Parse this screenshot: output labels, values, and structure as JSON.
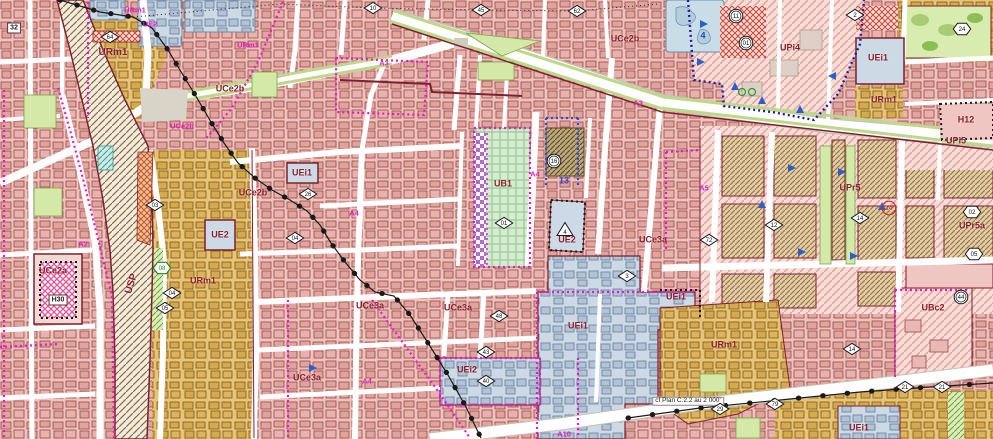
{
  "map": {
    "kind": "urban-zoning-plan",
    "plan_reference_note": "cf Plan C.2.2 au 2 000'",
    "colors": {
      "pink_zone": "#eec3be",
      "pink_building": "#dfa49e",
      "building_outline": "#9a4a46",
      "tan_zone": "#e8c478",
      "tan_building": "#d5a94e",
      "blue_zone": "#cdd9e5",
      "blue_building": "#b2c3d5",
      "green_grid_zone": "#d6ecd0",
      "park_green": "#d4e8a8",
      "rail_band": "#f3ecda",
      "rail_hatch": "#8a6b4c",
      "magenta_border": "#ea18c8",
      "navy_border": "#20209a",
      "blue_border": "#2a50d8",
      "black_border": "#1c1c1c",
      "dark_red_border": "#7c2130",
      "zone_label": "#8c1f2e",
      "street_label": "#e020c0",
      "blue_label": "#2848c8"
    },
    "labels": [
      {
        "text": "URm1",
        "x": 113,
        "y": 53,
        "style": "zone",
        "size": "big"
      },
      {
        "text": "UCe2b",
        "x": 230,
        "y": 89,
        "style": "zone"
      },
      {
        "text": "UCe2b",
        "x": 625,
        "y": 39,
        "style": "zone"
      },
      {
        "text": "UCe2b",
        "x": 253,
        "y": 193,
        "style": "zone"
      },
      {
        "text": "UCe2a",
        "x": 53,
        "y": 271,
        "style": "zone"
      },
      {
        "text": "URm1",
        "x": 203,
        "y": 281,
        "style": "zone"
      },
      {
        "text": "UEi1",
        "x": 302,
        "y": 173,
        "style": "zone"
      },
      {
        "text": "UE2",
        "x": 220,
        "y": 235,
        "style": "zone"
      },
      {
        "text": "UB1",
        "x": 503,
        "y": 184,
        "style": "zone"
      },
      {
        "text": "UE2",
        "x": 567,
        "y": 240,
        "style": "zone"
      },
      {
        "text": "UCe3a",
        "x": 653,
        "y": 240,
        "style": "zone"
      },
      {
        "text": "UCe3a",
        "x": 370,
        "y": 306,
        "style": "zone"
      },
      {
        "text": "UCe3a",
        "x": 458,
        "y": 308,
        "style": "zone"
      },
      {
        "text": "UCe3a",
        "x": 307,
        "y": 378,
        "style": "zone"
      },
      {
        "text": "UEi2",
        "x": 467,
        "y": 370,
        "style": "zone"
      },
      {
        "text": "UEi1",
        "x": 578,
        "y": 326,
        "style": "zone"
      },
      {
        "text": "UEi1",
        "x": 676,
        "y": 297,
        "style": "zone"
      },
      {
        "text": "URm1",
        "x": 724,
        "y": 345,
        "style": "zone"
      },
      {
        "text": "UEi1",
        "x": 859,
        "y": 428,
        "style": "zone"
      },
      {
        "text": "UPi4",
        "x": 790,
        "y": 48,
        "style": "zone"
      },
      {
        "text": "UPr5",
        "x": 850,
        "y": 188,
        "style": "zone"
      },
      {
        "text": "UPr5a",
        "x": 972,
        "y": 226,
        "style": "zone"
      },
      {
        "text": "UPi5",
        "x": 956,
        "y": 141,
        "style": "zone"
      },
      {
        "text": "URm1",
        "x": 884,
        "y": 100,
        "style": "zone"
      },
      {
        "text": "UEi1",
        "x": 878,
        "y": 58,
        "style": "zone"
      },
      {
        "text": "H12",
        "x": 966,
        "y": 120,
        "style": "zone"
      },
      {
        "text": "UBc2",
        "x": 933,
        "y": 308,
        "style": "zone"
      },
      {
        "text": "USP",
        "x": 132,
        "y": 284,
        "style": "usp"
      },
      {
        "text": "URm1",
        "x": 135,
        "y": 10,
        "style": "street"
      },
      {
        "text": "UE2",
        "x": 150,
        "y": 24,
        "style": "street"
      },
      {
        "text": "URm1",
        "x": 248,
        "y": 45,
        "style": "street"
      },
      {
        "text": "UCe2b",
        "x": 182,
        "y": 126,
        "style": "street"
      },
      {
        "text": "A2",
        "x": 83,
        "y": 244,
        "style": "street"
      },
      {
        "text": "A3",
        "x": 384,
        "y": 63,
        "style": "street"
      },
      {
        "text": "A3",
        "x": 638,
        "y": 103,
        "style": "street"
      },
      {
        "text": "A4",
        "x": 354,
        "y": 213,
        "style": "street"
      },
      {
        "text": "A4",
        "x": 535,
        "y": 174,
        "style": "street"
      },
      {
        "text": "A4",
        "x": 367,
        "y": 381,
        "style": "street"
      },
      {
        "text": "A5",
        "x": 704,
        "y": 188,
        "style": "street"
      },
      {
        "text": "A10",
        "x": 564,
        "y": 434,
        "style": "street"
      },
      {
        "text": "13",
        "x": 564,
        "y": 181,
        "style": "blue"
      },
      {
        "text": "4",
        "x": 703,
        "y": 36,
        "style": "blue"
      },
      {
        "text": "32",
        "x": 14,
        "y": 28,
        "style": "box"
      },
      {
        "text": "H30",
        "x": 58,
        "y": 300,
        "style": "box"
      },
      {
        "text": "cf Plan C.2.2 au 2 000'",
        "x": 688,
        "y": 401,
        "style": "note"
      }
    ],
    "markers": [
      {
        "shape": "diamond",
        "value": "64",
        "x": 110,
        "y": 37
      },
      {
        "shape": "diamond",
        "value": "03",
        "x": 155,
        "y": 205
      },
      {
        "shape": "diamond",
        "value": "04",
        "x": 172,
        "y": 293
      },
      {
        "shape": "diamond",
        "value": "05",
        "x": 165,
        "y": 308
      },
      {
        "shape": "diamond",
        "value": "26",
        "x": 308,
        "y": 194
      },
      {
        "shape": "diamond",
        "value": "04",
        "x": 295,
        "y": 238
      },
      {
        "shape": "diamond",
        "value": "01",
        "x": 504,
        "y": 223
      },
      {
        "shape": "diamond",
        "value": "48",
        "x": 499,
        "y": 316
      },
      {
        "shape": "diamond",
        "value": "43",
        "x": 486,
        "y": 352
      },
      {
        "shape": "diamond",
        "value": "40",
        "x": 486,
        "y": 381
      },
      {
        "shape": "diamond",
        "value": "14",
        "x": 860,
        "y": 218
      },
      {
        "shape": "diamond",
        "value": "12",
        "x": 774,
        "y": 225
      },
      {
        "shape": "diamond",
        "value": "72",
        "x": 709,
        "y": 240
      },
      {
        "shape": "diamond",
        "value": "29",
        "x": 720,
        "y": 409
      },
      {
        "shape": "diamond",
        "value": "79",
        "x": 775,
        "y": 404
      },
      {
        "shape": "diamond",
        "value": "14",
        "x": 852,
        "y": 349
      },
      {
        "shape": "diamond",
        "value": "21",
        "x": 905,
        "y": 387
      },
      {
        "shape": "diamond",
        "value": "21",
        "x": 942,
        "y": 387
      },
      {
        "shape": "diamond",
        "value": "10",
        "x": 373,
        "y": 8
      },
      {
        "shape": "diamond",
        "value": "45",
        "x": 481,
        "y": 10
      },
      {
        "shape": "diamond",
        "value": "62",
        "x": 577,
        "y": 11
      },
      {
        "shape": "diamond",
        "value": "2",
        "x": 855,
        "y": 15
      },
      {
        "shape": "diamond",
        "value": "3",
        "x": 627,
        "y": 276
      },
      {
        "shape": "circle",
        "value": "11",
        "x": 736,
        "y": 16
      },
      {
        "shape": "circle",
        "value": "01",
        "x": 746,
        "y": 43
      },
      {
        "shape": "circle",
        "value": "16",
        "x": 554,
        "y": 161
      },
      {
        "shape": "circle",
        "value": "44",
        "x": 961,
        "y": 297
      },
      {
        "shape": "circle-red",
        "value": "14",
        "x": 889,
        "y": 208
      },
      {
        "shape": "hexagon-green",
        "value": "08",
        "x": 162,
        "y": 268
      },
      {
        "shape": "hexagon",
        "value": "24",
        "x": 962,
        "y": 29
      },
      {
        "shape": "hexagon",
        "value": "02",
        "x": 972,
        "y": 212
      },
      {
        "shape": "hexagon",
        "value": "05",
        "x": 974,
        "y": 254
      },
      {
        "shape": "triangle",
        "value": "4",
        "x": 565,
        "y": 229
      }
    ]
  }
}
